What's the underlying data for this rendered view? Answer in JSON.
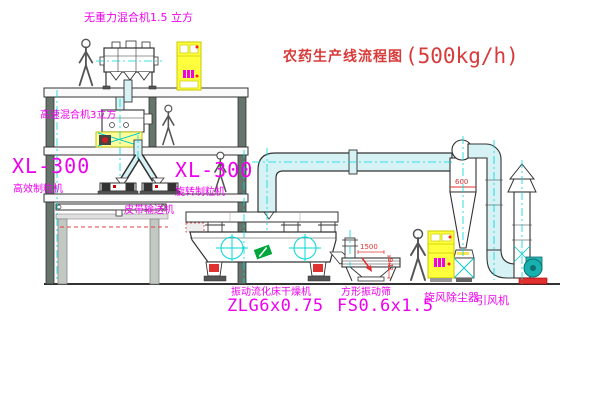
{
  "title": {
    "name": "农药生产线流程图",
    "capacity": "(500kg/h)"
  },
  "labels": {
    "zero_gravity_mixer": "无重力混合机1.5 立方",
    "high_speed_mixer": "高速混合机3立方",
    "granulator_left_model": "XL-300",
    "granulator_left_name": "高效制粒机",
    "granulator_right_model": "XL-300",
    "granulator_right_name": "旋转制粒机",
    "belt_conveyor": "皮带输送机",
    "dryer_name": "振动流化床干燥机",
    "dryer_model": "ZLG6x0.75",
    "screen_name": "方形振动筛",
    "screen_model": "FS0.6x1.5",
    "cyclone_collector": "旋风除尘器",
    "induced_draft_fan": "引风机"
  },
  "dimensions": {
    "cyclone_outlet": "600",
    "screen_length": "1500",
    "screen_height": "941"
  },
  "colors": {
    "label_magenta": "#ee00ee",
    "title_red": "#d93a3a",
    "centerline_cyan": "#00d8d8",
    "duct_fill": "#d6f2f4",
    "cabinet_yellow": "#ffff3d",
    "fan_teal": "#19b0b0",
    "spring_red": "#e03030"
  }
}
